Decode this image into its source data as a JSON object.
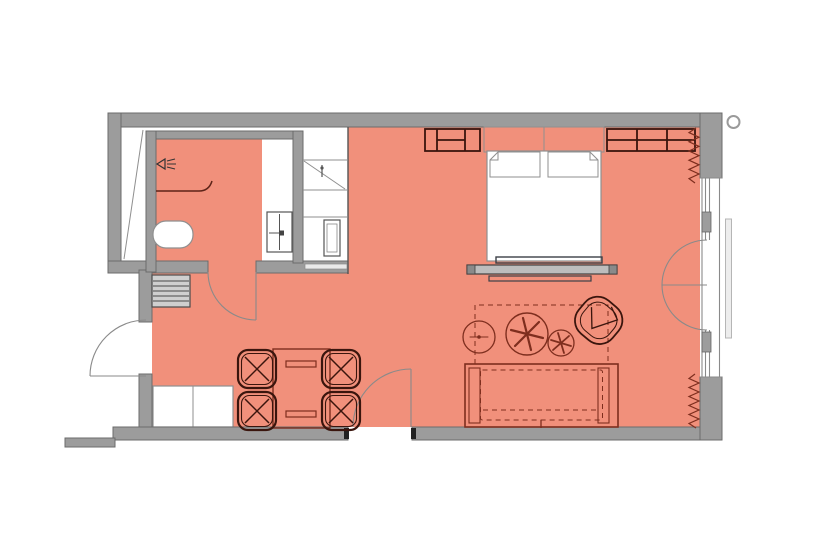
{
  "canvas": {
    "width": 831,
    "height": 555
  },
  "colors": {
    "background": "#FFFFFF",
    "floor": "#F1907B",
    "wall": "#9C9C9C",
    "wall_outline": "#6B6B6B",
    "furniture_maroon": "#7E2E1E",
    "furniture_dark": "#3A150D",
    "fixture_outline": "#8F8F8F",
    "door_line": "#8A8A8A",
    "bench_gray": "#BDBDBD",
    "mullion_gray": "#9D9D9D",
    "railing_gray": "#EDEDED"
  },
  "symbols": [
    {
      "name": "shower-head-icon"
    },
    {
      "name": "shower-screen"
    },
    {
      "name": "toilet"
    },
    {
      "name": "vanity-basin"
    },
    {
      "name": "service-shaft"
    },
    {
      "name": "wardrobe-hanging-rail"
    },
    {
      "name": "wardrobe-safe"
    },
    {
      "name": "luggage-rack"
    },
    {
      "name": "entry-door-swing"
    },
    {
      "name": "bathroom-door-swing"
    },
    {
      "name": "room-door-swing"
    },
    {
      "name": "french-door-swings"
    },
    {
      "name": "window-band"
    },
    {
      "name": "curtain-zigzag-top"
    },
    {
      "name": "curtain-zigzag-bottom"
    },
    {
      "name": "balcony-railing"
    },
    {
      "name": "column-marker"
    },
    {
      "name": "minibar-cabinet"
    },
    {
      "name": "dining-table"
    },
    {
      "name": "dining-chair",
      "count": 4
    },
    {
      "name": "sofa"
    },
    {
      "name": "rug-dashed-outline"
    },
    {
      "name": "side-table-large"
    },
    {
      "name": "side-table-small"
    },
    {
      "name": "side-table-left"
    },
    {
      "name": "armchair"
    },
    {
      "name": "bed"
    },
    {
      "name": "headboard"
    },
    {
      "name": "pillow",
      "count": 2
    },
    {
      "name": "foot-bench"
    },
    {
      "name": "nightstand-left"
    },
    {
      "name": "nightstand-right"
    }
  ]
}
